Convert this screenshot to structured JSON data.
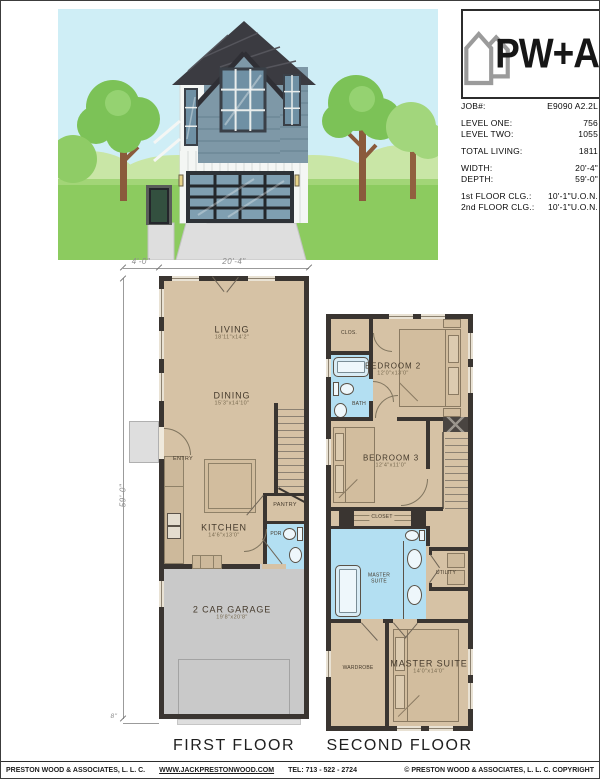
{
  "title_block": {
    "logo_text": "PW+A",
    "specs": [
      {
        "label": "JOB#:",
        "value": "E9090 A2.2L"
      },
      {
        "label": "LEVEL ONE:",
        "value": "756"
      },
      {
        "label": "LEVEL TWO:",
        "value": "1055"
      },
      {
        "label": "TOTAL LIVING:",
        "value": "1811"
      },
      {
        "label": "WIDTH:",
        "value": "20'-4\""
      },
      {
        "label": "DEPTH:",
        "value": "59'-0\""
      },
      {
        "label": "1st FLOOR CLG.:",
        "value": "10'-1\"U.O.N."
      },
      {
        "label": "2nd FLOOR CLG.:",
        "value": "10'-1\"U.O.N."
      }
    ]
  },
  "first_floor": {
    "label": "FIRST FLOOR",
    "dims": {
      "porch": "4'-0\"",
      "width": "20'-4\"",
      "depth": "59'-0\"",
      "offset": "8\""
    },
    "rooms": {
      "living": {
        "name": "LIVING",
        "size": "18'11\"x14'2\""
      },
      "dining": {
        "name": "DINING",
        "size": "15'3\"x14'10\""
      },
      "entry": {
        "name": "ENTRY"
      },
      "kitchen": {
        "name": "KITCHEN",
        "size": "14'6\"x13'0\""
      },
      "pantry": {
        "name": "PANTRY"
      },
      "powder": {
        "name": "PDR"
      },
      "garage": {
        "name": "2 CAR GARAGE",
        "size": "19'8\"x20'8\""
      }
    }
  },
  "second_floor": {
    "label": "SECOND FLOOR",
    "rooms": {
      "clos": {
        "name": "CLOS."
      },
      "bath": {
        "name": "BATH"
      },
      "bedroom2": {
        "name": "BEDROOM 2",
        "size": "12'0\"x13'0\""
      },
      "bedroom3": {
        "name": "BEDROOM 3",
        "size": "12'4\"x11'0\""
      },
      "closet": {
        "name": "CLOSET"
      },
      "master_bath": {
        "line1": "MASTER",
        "line2": "SUITE"
      },
      "utility": {
        "name": "UTILITY"
      },
      "wardrobe": {
        "name": "WARDROBE"
      },
      "master": {
        "name": "MASTER SUITE",
        "size": "14'0\"x14'0\""
      }
    }
  },
  "footer": {
    "company": "PRESTON WOOD & ASSOCIATES, L. L. C.",
    "website": "WWW.JACKPRESTONWOOD.COM",
    "phone": "TEL:  713 - 522 - 2724",
    "copyright": "© PRESTON WOOD & ASSOCIATES, L. L. C.  COPYRIGHT"
  },
  "colors": {
    "floor_tan": "#d6c2a5",
    "wall": "#3a3531",
    "bath_blue": "#b3dff2",
    "garage_gray": "#c9c9c9",
    "sky": "#cfeef6",
    "grass": "#8ccb5f",
    "roof": "#3b3b41",
    "siding_slate": "#7e98a7",
    "logo_gray": "#9b9b9b"
  }
}
